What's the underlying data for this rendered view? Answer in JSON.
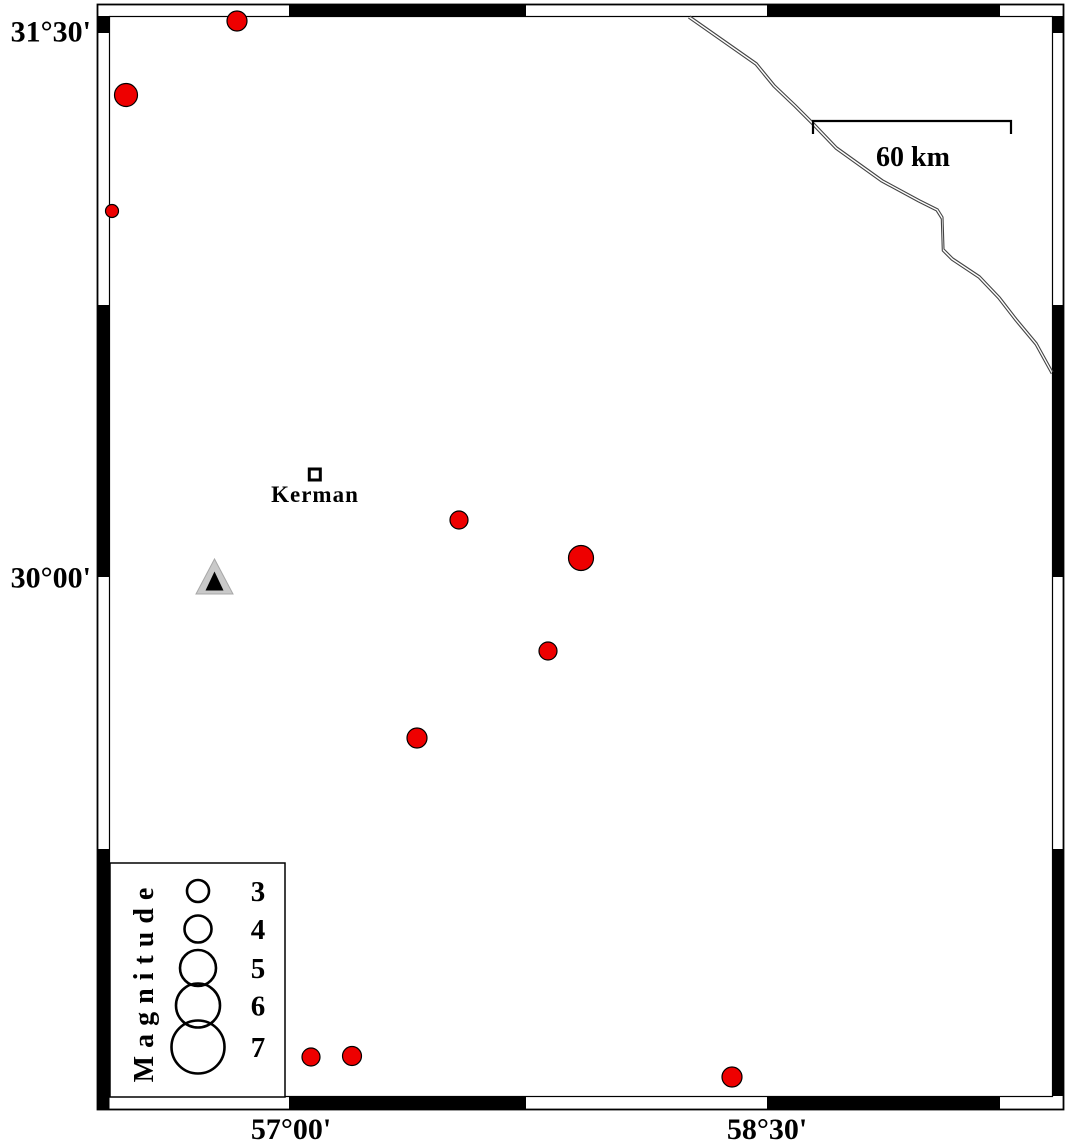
{
  "map": {
    "background": "#ffffff",
    "frame": {
      "outer": [
        97.5,
        4.5,
        1063.5,
        1109.5
      ],
      "inner": [
        109.5,
        16.5,
        1052.5,
        1096.5
      ],
      "black_segments": {
        "top": [
          [
            289,
            526
          ],
          [
            767,
            1000
          ]
        ],
        "bottom": [
          [
            289,
            526
          ],
          [
            767,
            1000
          ]
        ],
        "left": [
          [
            16,
            33
          ],
          [
            305,
            577
          ],
          [
            849,
            1109
          ]
        ],
        "right": [
          [
            16,
            33
          ],
          [
            305,
            577
          ],
          [
            849,
            1096
          ]
        ]
      }
    },
    "axis": {
      "y_ticks": [
        {
          "label": "31°30'",
          "y": 31
        },
        {
          "label": "30°00'",
          "y": 577
        }
      ],
      "x_ticks": [
        {
          "label": "57°00'",
          "x": 291
        },
        {
          "label": "58°30'",
          "x": 767
        }
      ]
    },
    "scale_bar": {
      "label": "60 km",
      "x1": 813,
      "x2": 1011,
      "y": 121,
      "tick_drop": 13
    },
    "border_line": {
      "points": [
        [
          690,
          16
        ],
        [
          757,
          63
        ],
        [
          775,
          85
        ],
        [
          796,
          105
        ],
        [
          815,
          124
        ],
        [
          837,
          147
        ],
        [
          883,
          180
        ],
        [
          920,
          200
        ],
        [
          938,
          209
        ],
        [
          943,
          217
        ],
        [
          944,
          249
        ],
        [
          953,
          258
        ],
        [
          980,
          276
        ],
        [
          1000,
          297
        ],
        [
          1017,
          319
        ],
        [
          1037,
          343
        ],
        [
          1053,
          372
        ]
      ]
    },
    "city": {
      "name": "Kerman",
      "x": 314.8,
      "y": 474.5,
      "marker_size": 11
    },
    "station": {
      "outer": [
        [
          214.5,
          559
        ],
        [
          196,
          594
        ],
        [
          233,
          594
        ]
      ],
      "inner": [
        [
          214.5,
          571.5
        ],
        [
          205.5,
          590.5
        ],
        [
          223.5,
          590.5
        ]
      ]
    },
    "earthquakes": [
      {
        "x": 237,
        "y": 21,
        "r": 10
      },
      {
        "x": 126,
        "y": 95,
        "r": 11.5
      },
      {
        "x": 112,
        "y": 211,
        "r": 6.5
      },
      {
        "x": 459,
        "y": 520,
        "r": 9
      },
      {
        "x": 581,
        "y": 558,
        "r": 12.5
      },
      {
        "x": 548,
        "y": 651,
        "r": 9
      },
      {
        "x": 417,
        "y": 738,
        "r": 10
      },
      {
        "x": 311,
        "y": 1057,
        "r": 9
      },
      {
        "x": 352,
        "y": 1056,
        "r": 9.5
      },
      {
        "x": 732,
        "y": 1077,
        "r": 10
      }
    ],
    "colors": {
      "earthquake_fill": "#ee0000",
      "marker_outline": "#000000",
      "border_line": "#444444",
      "station_fill": "#c9c9c9",
      "station_inner": "#000000"
    }
  },
  "legend": {
    "title": "Magnitude",
    "box": {
      "x": 110,
      "y": 863,
      "w": 175,
      "h": 234
    },
    "symbol_cx": 198,
    "label_cx": 258,
    "entries": [
      {
        "magnitude": "3",
        "r": 11,
        "cy": 891
      },
      {
        "magnitude": "4",
        "r": 13.5,
        "cy": 929
      },
      {
        "magnitude": "5",
        "r": 18,
        "cy": 968
      },
      {
        "magnitude": "6",
        "r": 22,
        "cy": 1005.5
      },
      {
        "magnitude": "7",
        "r": 26.5,
        "cy": 1047
      }
    ]
  }
}
